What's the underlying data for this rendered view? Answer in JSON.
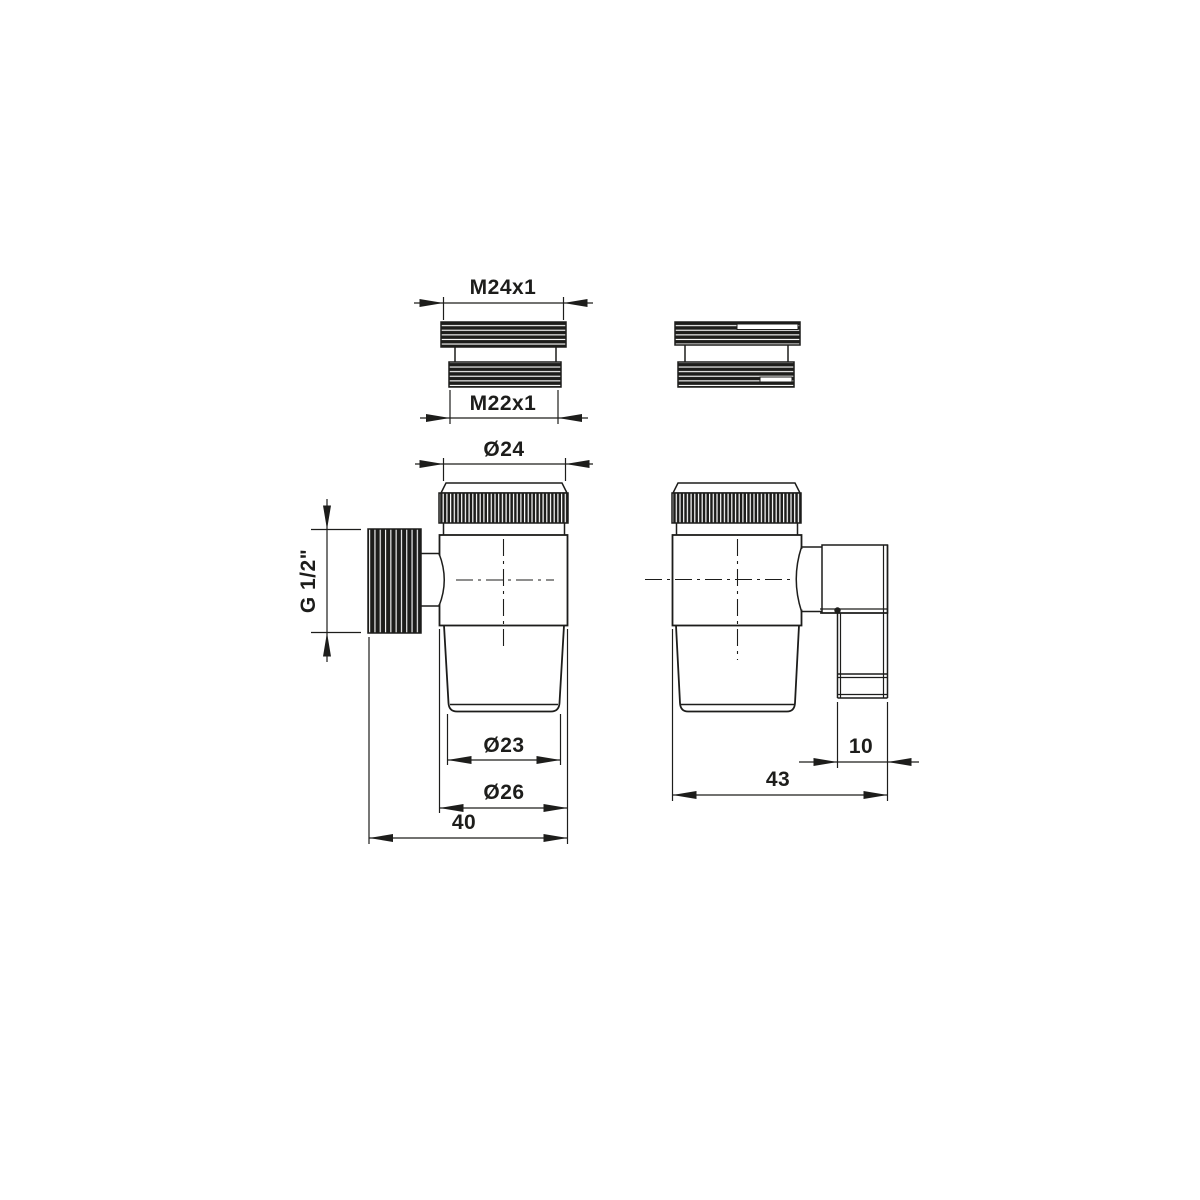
{
  "drawing": {
    "type": "technical-dimension-drawing",
    "background": "#ffffff",
    "line_color": "#1d1d1b",
    "views": {
      "adapter_front": "threaded adapter front view",
      "adapter_rotated": "threaded adapter rotated view",
      "valve_front": "valve body front view",
      "valve_side": "valve body side view with elbow outlet"
    },
    "dimensions": {
      "adapter_top_thread": "M24x1",
      "adapter_bottom_thread": "M22x1",
      "cap_diameter": "Ø24",
      "side_thread": "G 1/2\"",
      "outlet_inner_diameter": "Ø23",
      "body_diameter": "Ø26",
      "front_width": "40",
      "side_depth": "43",
      "port_width": "10"
    }
  }
}
